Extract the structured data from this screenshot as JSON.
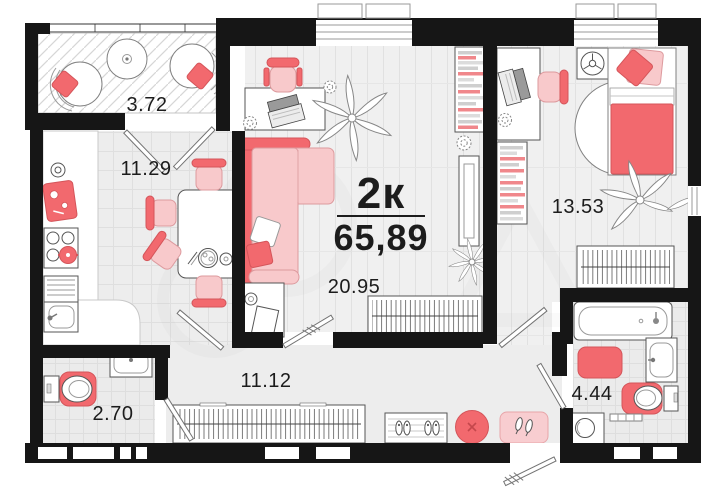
{
  "plan": {
    "title": {
      "rooms": "2к",
      "area": "65,89"
    },
    "rooms": {
      "balcony": "3.72",
      "kitchen": "11.29",
      "living": "20.95",
      "bedroom": "13.53",
      "hallway": "11.12",
      "wc": "2.70",
      "bathroom": "4.44"
    },
    "colors": {
      "wall": "#161616",
      "accent": "#f2696e",
      "accent_dark": "#d4555a",
      "accent_light": "#f8c9cb",
      "accent_pale": "#f8cdd0",
      "outline": "#555555"
    }
  }
}
